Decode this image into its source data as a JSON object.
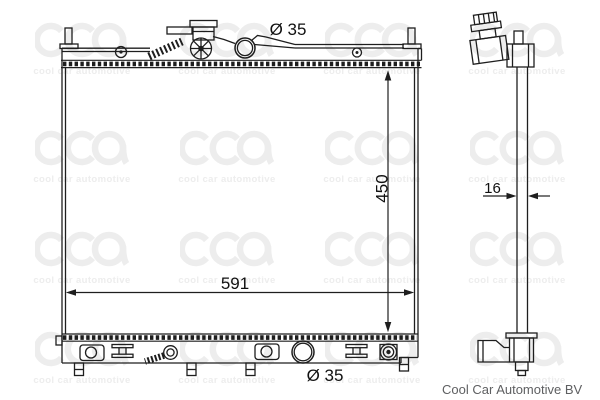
{
  "watermark": {
    "logo": "cca",
    "text": "cool car automotive"
  },
  "dimensions": {
    "top_port_diameter": "Ø 35",
    "core_height": "450",
    "core_width": "591",
    "bottom_port_diameter": "Ø 35",
    "thickness": "16"
  },
  "footer": {
    "brand": "Cool Car Automotive BV"
  },
  "colors": {
    "line": "#1e1e1e",
    "label": "#111111",
    "footer": "#5e5f61",
    "watermark": "#ededed"
  }
}
